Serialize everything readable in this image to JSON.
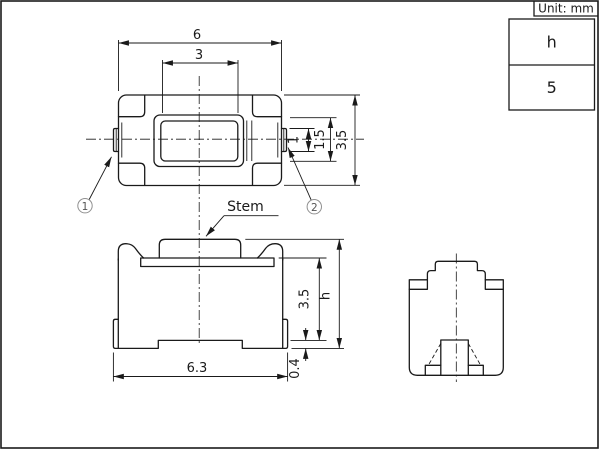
{
  "frame": {
    "unit_label": "Unit: mm"
  },
  "spec_table": {
    "param": "h",
    "value": "5"
  },
  "top_view": {
    "dim_body_width": "6",
    "dim_stem_width": "3",
    "dim_terminal_width": "1",
    "dim_stem_depth": "1.5",
    "dim_body_depth": "3.5",
    "callout_1": "1",
    "callout_2": "2"
  },
  "front_view": {
    "stem_label": "Stem",
    "dim_overall_width": "6.3",
    "dim_standoff": "0.4",
    "dim_base_height": "3.5",
    "dim_total_height": "h"
  }
}
